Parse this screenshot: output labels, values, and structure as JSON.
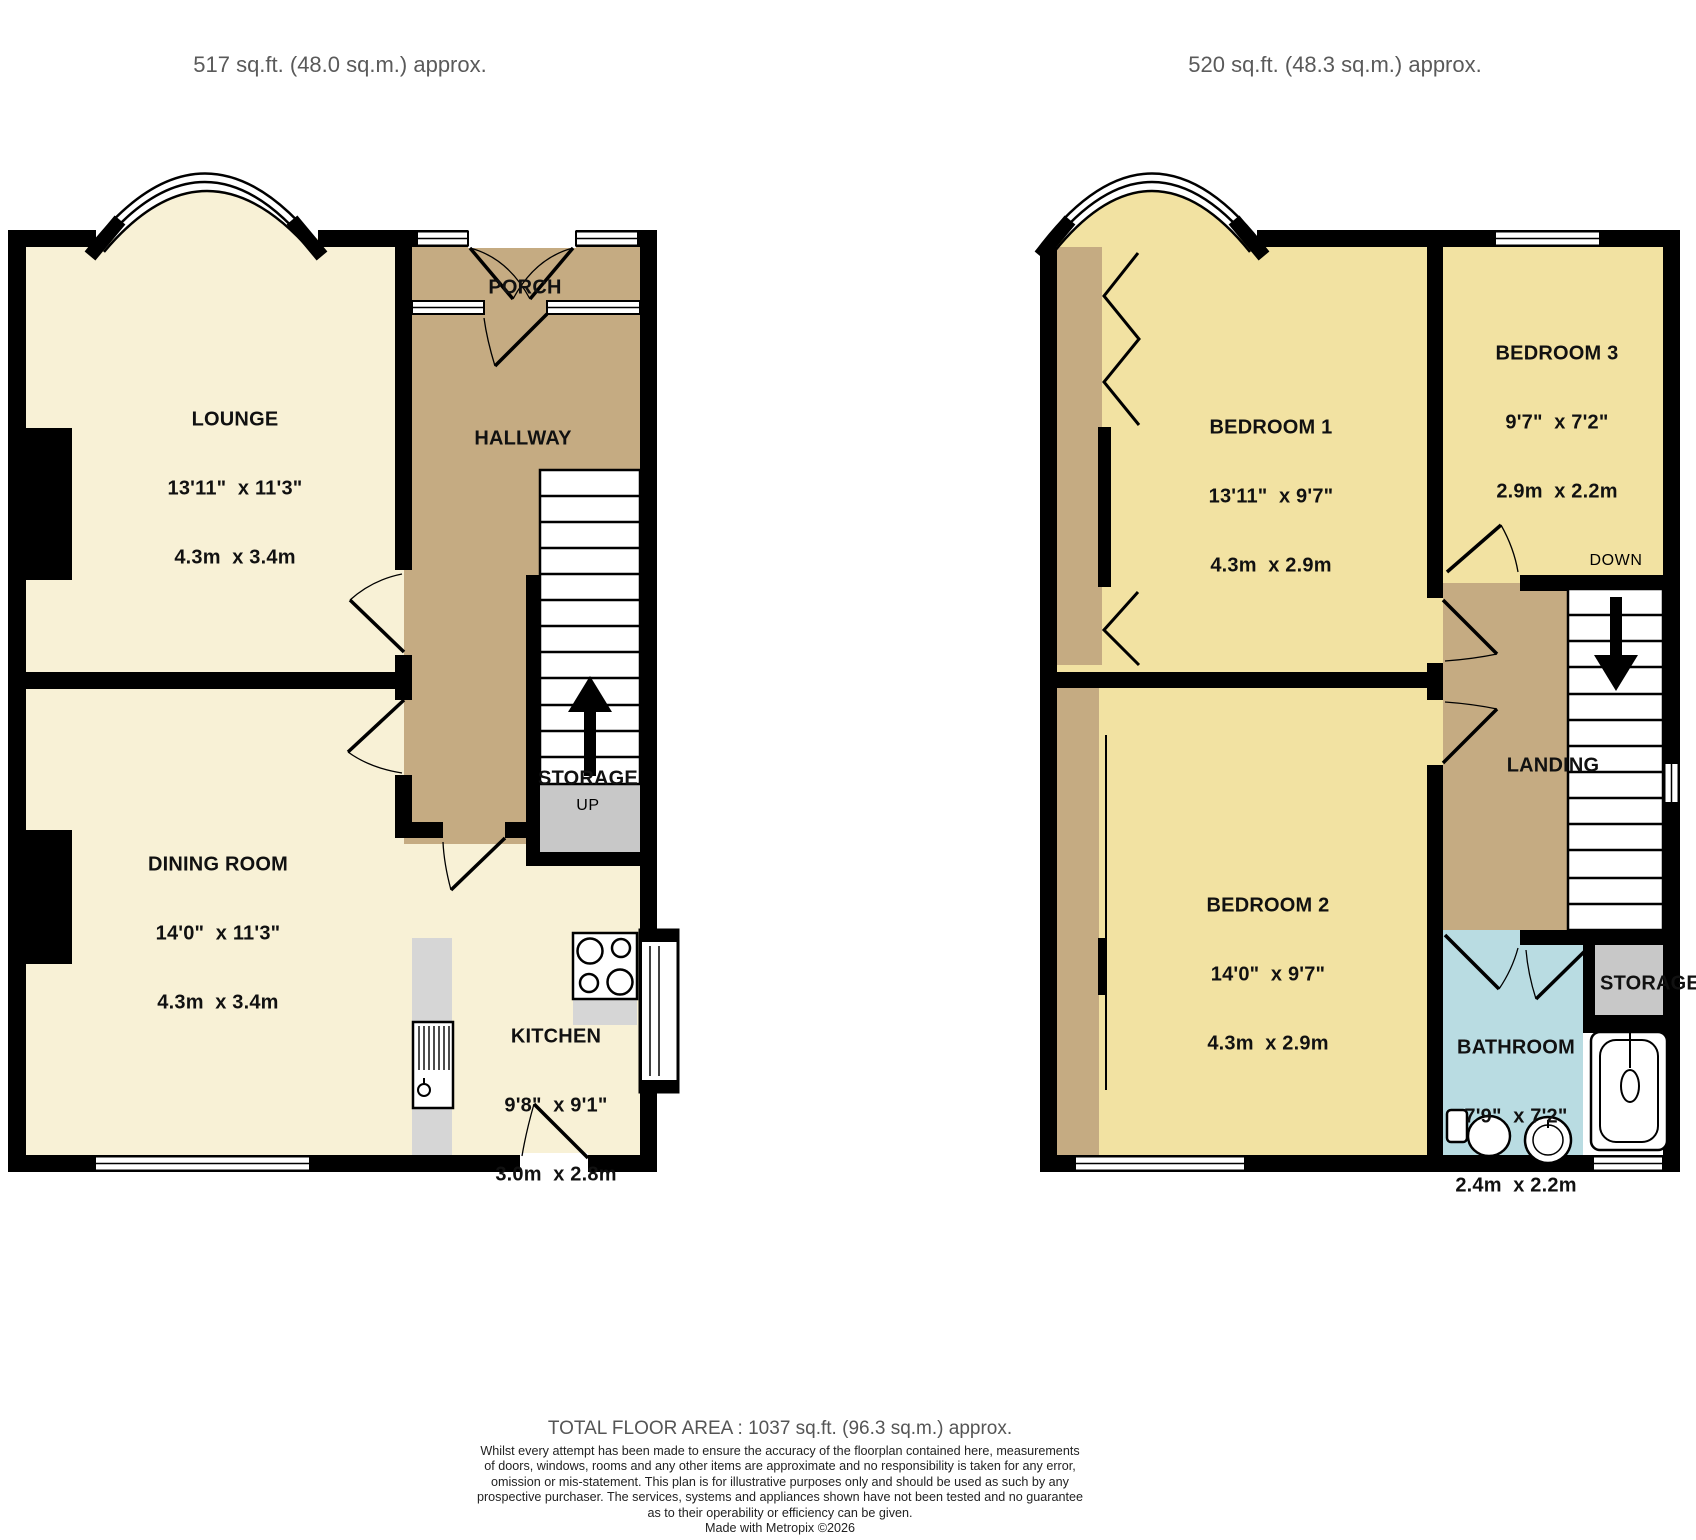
{
  "palette": {
    "wall": "#000000",
    "ground_room_cream": "#f8f1d6",
    "hall_tan": "#c5ab82",
    "bedroom_yellow": "#f2e2a2",
    "bathroom_blue": "#b9dce2",
    "storage_gray": "#c8c8c8",
    "counter_gray": "#d6d6d6",
    "heading_text": "#5a5a5a",
    "label_text": "#111111"
  },
  "headers": {
    "ground": {
      "title": "GROUND FLOOR",
      "area": "517 sq.ft. (48.0 sq.m.) approx."
    },
    "first": {
      "title": "1ST FLOOR",
      "area": "520 sq.ft. (48.3 sq.m.) approx."
    }
  },
  "ground_floor": {
    "lounge": {
      "name": "LOUNGE",
      "imperial": "13'11\"  x 11'3\"",
      "metric": "4.3m  x 3.4m"
    },
    "dining_room": {
      "name": "DINING ROOM",
      "imperial": "14'0\"  x 11'3\"",
      "metric": "4.3m  x 3.4m"
    },
    "kitchen": {
      "name": "KITCHEN",
      "imperial": "9'8\"  x 9'1\"",
      "metric": "3.0m  x 2.8m"
    },
    "hallway": {
      "name": "HALLWAY"
    },
    "porch": {
      "name": "PORCH"
    },
    "storage": {
      "name": "STORAGE"
    },
    "stairs": {
      "direction": "UP"
    }
  },
  "first_floor": {
    "bedroom1": {
      "name": "BEDROOM 1",
      "imperial": "13'11\"  x 9'7\"",
      "metric": "4.3m  x 2.9m"
    },
    "bedroom2": {
      "name": "BEDROOM 2",
      "imperial": "14'0\"  x 9'7\"",
      "metric": "4.3m  x 2.9m"
    },
    "bedroom3": {
      "name": "BEDROOM 3",
      "imperial": "9'7\"  x 7'2\"",
      "metric": "2.9m  x 2.2m"
    },
    "bathroom": {
      "name": "BATHROOM",
      "imperial": "7'9\"  x 7'2\"",
      "metric": "2.4m  x 2.2m"
    },
    "landing": {
      "name": "LANDING"
    },
    "storage": {
      "name": "STORAGE"
    },
    "stairs": {
      "direction": "DOWN"
    }
  },
  "footer": {
    "total_area": "TOTAL FLOOR AREA : 1037 sq.ft. (96.3 sq.m.) approx.",
    "disclaimer_lines": [
      "Whilst every attempt has been made to ensure the accuracy of the floorplan contained here, measurements",
      "of doors, windows, rooms and any other items are approximate and no responsibility is taken for any error,",
      "omission or mis-statement. This plan is for illustrative purposes only and should be used as such by any",
      "prospective purchaser. The services, systems and appliances shown have not been tested and no guarantee",
      "as to their operability or efficiency can be given."
    ],
    "credit": "Made with Metropix ©2026"
  }
}
